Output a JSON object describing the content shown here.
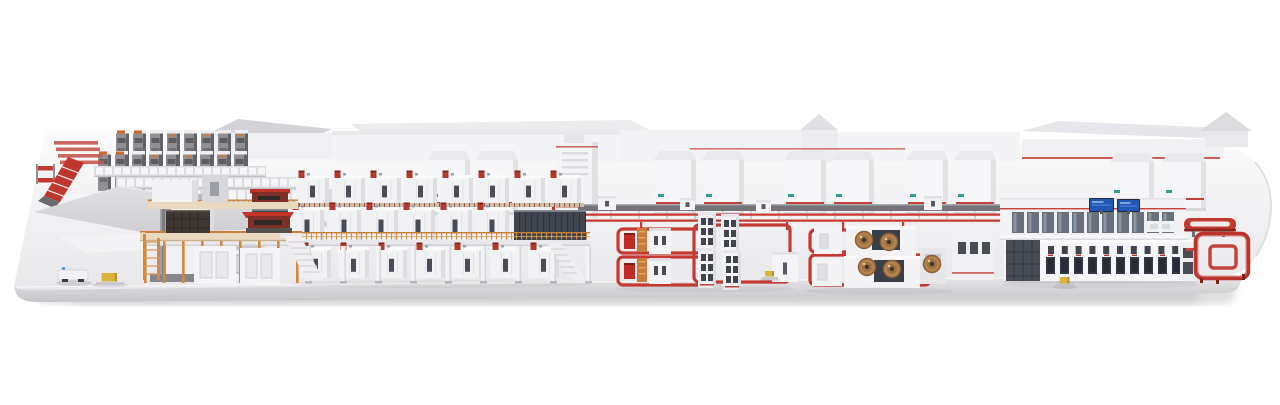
{
  "scene": {
    "palette": {
      "bg": "#ffffff",
      "platform_top_a": "#fcfcfd",
      "platform_top_b": "#e8e8eb",
      "platform_face_a": "#e8e8ea",
      "platform_face_b": "#c6c6ca",
      "sheet_a": "#e0e0e3",
      "sheet_b": "#c8c8cc",
      "machine_white": "#f2f2f4",
      "machine_top": "#fafafb",
      "machine_side": "#dedee2",
      "machine_dark": "#474c55",
      "accent_red": "#c43a30",
      "accent_red_dark": "#8e251e",
      "valve_red": "#b3382f",
      "rail_orange": "#cf8a3e",
      "rail_orange_dark": "#c87f35",
      "deck_cream": "#e8d9c0",
      "walkway_tan": "#cdbca9",
      "walkway_tick": "#9c5a4a",
      "rack_gray": "#8f8f94",
      "rack_dark": "#626267",
      "rack_cap": "#efeff1",
      "rack_orange": "#d2672d",
      "glass": "#68707c",
      "screen_blue": "#2257b4",
      "screen_blue_light": "#7ea4e0",
      "coil_copper": "#b5824f",
      "coil_mid": "#9c7242",
      "coil_core": "#41352a",
      "cart_yellow": "#d9b33c",
      "shadow": "#3c3c46"
    },
    "racks": {
      "rows": [
        {
          "x": 116,
          "y": 130,
          "count": 8,
          "step": 17,
          "w": 13,
          "h": 42
        },
        {
          "x": 98,
          "y": 151,
          "count": 9,
          "step": 17,
          "w": 13,
          "h": 40
        }
      ],
      "shelves": [
        {
          "x": 94,
          "y": 166,
          "w": 172,
          "h": 11
        },
        {
          "x": 116,
          "y": 177,
          "w": 192,
          "h": 12
        },
        {
          "x": 146,
          "y": 189,
          "w": 188,
          "h": 14
        }
      ]
    },
    "cabinets": {
      "mid": {
        "y": 160,
        "w": 42,
        "h": 52,
        "xs": [
          428,
          476,
          654,
          702,
          784,
          832,
          906,
          954
        ]
      },
      "right": {
        "y": 162,
        "w": 44,
        "h": 46,
        "xs": [
          1110,
          1162
        ]
      }
    },
    "main_line": {
      "rows": [
        {
          "x": 296,
          "y": 175,
          "count": 8,
          "step": 36,
          "w": 33,
          "h": 28
        },
        {
          "x": 290,
          "y": 207,
          "count": 6,
          "step": 37,
          "w": 34,
          "h": 33
        },
        {
          "x": 300,
          "y": 247,
          "count": 7,
          "step": 38,
          "w": 31,
          "h": 31
        }
      ],
      "walkway": {
        "x": 294,
        "y": 203,
        "w": 290,
        "h": 4
      },
      "end_panels": [
        {
          "x": 252,
          "y": 209,
          "w": 36,
          "h": 31
        },
        {
          "x": 514,
          "y": 210,
          "w": 72,
          "h": 31
        }
      ],
      "rails": [
        {
          "x": 146,
          "y": 232,
          "w": 444
        },
        {
          "x": 148,
          "y": 199.5,
          "w": 150
        },
        {
          "x": 140,
          "y": 231,
          "w": 162
        }
      ],
      "deck": {
        "x": 146,
        "y": 240,
        "w": 444,
        "h": 6
      },
      "columns": {
        "x": 306,
        "y": 246,
        "count": 9,
        "step": 35,
        "w": 5,
        "h": 37
      },
      "orange_posts": {
        "x": 144,
        "y": 241,
        "count": 9,
        "step": 19,
        "h": 42
      }
    },
    "conveyor_rail": {
      "x": 578,
      "y": 204,
      "w": 430,
      "h": 7,
      "post_step": 28
    },
    "red_lines": [
      {
        "x": 566,
        "y": 213.5,
        "w": 442,
        "h": 2.2
      },
      {
        "x": 566,
        "y": 219.5,
        "w": 442,
        "h": 2.2
      }
    ],
    "loop_stubs": [
      640,
      700,
      786,
      842,
      902
    ],
    "floor_loops": [
      {
        "x": 618,
        "y": 229,
        "w": 90,
        "h": 24
      },
      {
        "x": 618,
        "y": 257,
        "w": 92,
        "h": 28
      },
      {
        "x": 694,
        "y": 225,
        "w": 96,
        "h": 57
      },
      {
        "x": 810,
        "y": 230,
        "w": 98,
        "h": 22
      },
      {
        "x": 810,
        "y": 255,
        "w": 120,
        "h": 30
      }
    ],
    "stations_a": [
      {
        "x": 624,
        "y": 226
      },
      {
        "x": 624,
        "y": 256
      }
    ],
    "towers_a": [
      {
        "x": 698,
        "y": 212
      },
      {
        "x": 721,
        "y": 214
      },
      {
        "x": 698,
        "y": 248
      },
      {
        "x": 723,
        "y": 250
      }
    ],
    "small_stations": [
      {
        "x": 598,
        "y": 196,
        "w": 18,
        "h": 14
      },
      {
        "x": 680,
        "y": 198,
        "w": 15,
        "h": 12
      },
      {
        "x": 756,
        "y": 200,
        "w": 15,
        "h": 12
      },
      {
        "x": 924,
        "y": 196,
        "w": 18,
        "h": 14
      },
      {
        "x": 772,
        "y": 252,
        "w": 26,
        "h": 30
      }
    ],
    "coils": [
      {
        "cx": 864,
        "cy": 240
      },
      {
        "cx": 889,
        "cy": 242
      },
      {
        "cx": 867,
        "cy": 267
      },
      {
        "cx": 892,
        "cy": 269
      },
      {
        "cx": 932,
        "cy": 264
      }
    ],
    "glass_windows": {
      "x": 1012,
      "y": 212,
      "count": 11,
      "step": 15,
      "w": 12,
      "h": 21
    },
    "screens": [
      {
        "x": 1090,
        "y": 199,
        "w": 23,
        "h": 12
      },
      {
        "x": 1118,
        "y": 200,
        "w": 21,
        "h": 11
      }
    ],
    "right_windows": {
      "upper": {
        "x": 1048,
        "y": 246,
        "count": 10,
        "step": 13.8,
        "w": 6,
        "h": 8
      },
      "lower": {
        "x": 1046,
        "y": 257,
        "count": 10,
        "step": 14,
        "w": 9,
        "h": 17
      }
    },
    "pallets": [
      {
        "x": 96,
        "y": 273,
        "w": 28,
        "h": 12
      },
      {
        "x": 762,
        "y": 271,
        "w": 16,
        "h": 9
      },
      {
        "x": 1056,
        "y": 277,
        "w": 18,
        "h": 10
      }
    ]
  }
}
